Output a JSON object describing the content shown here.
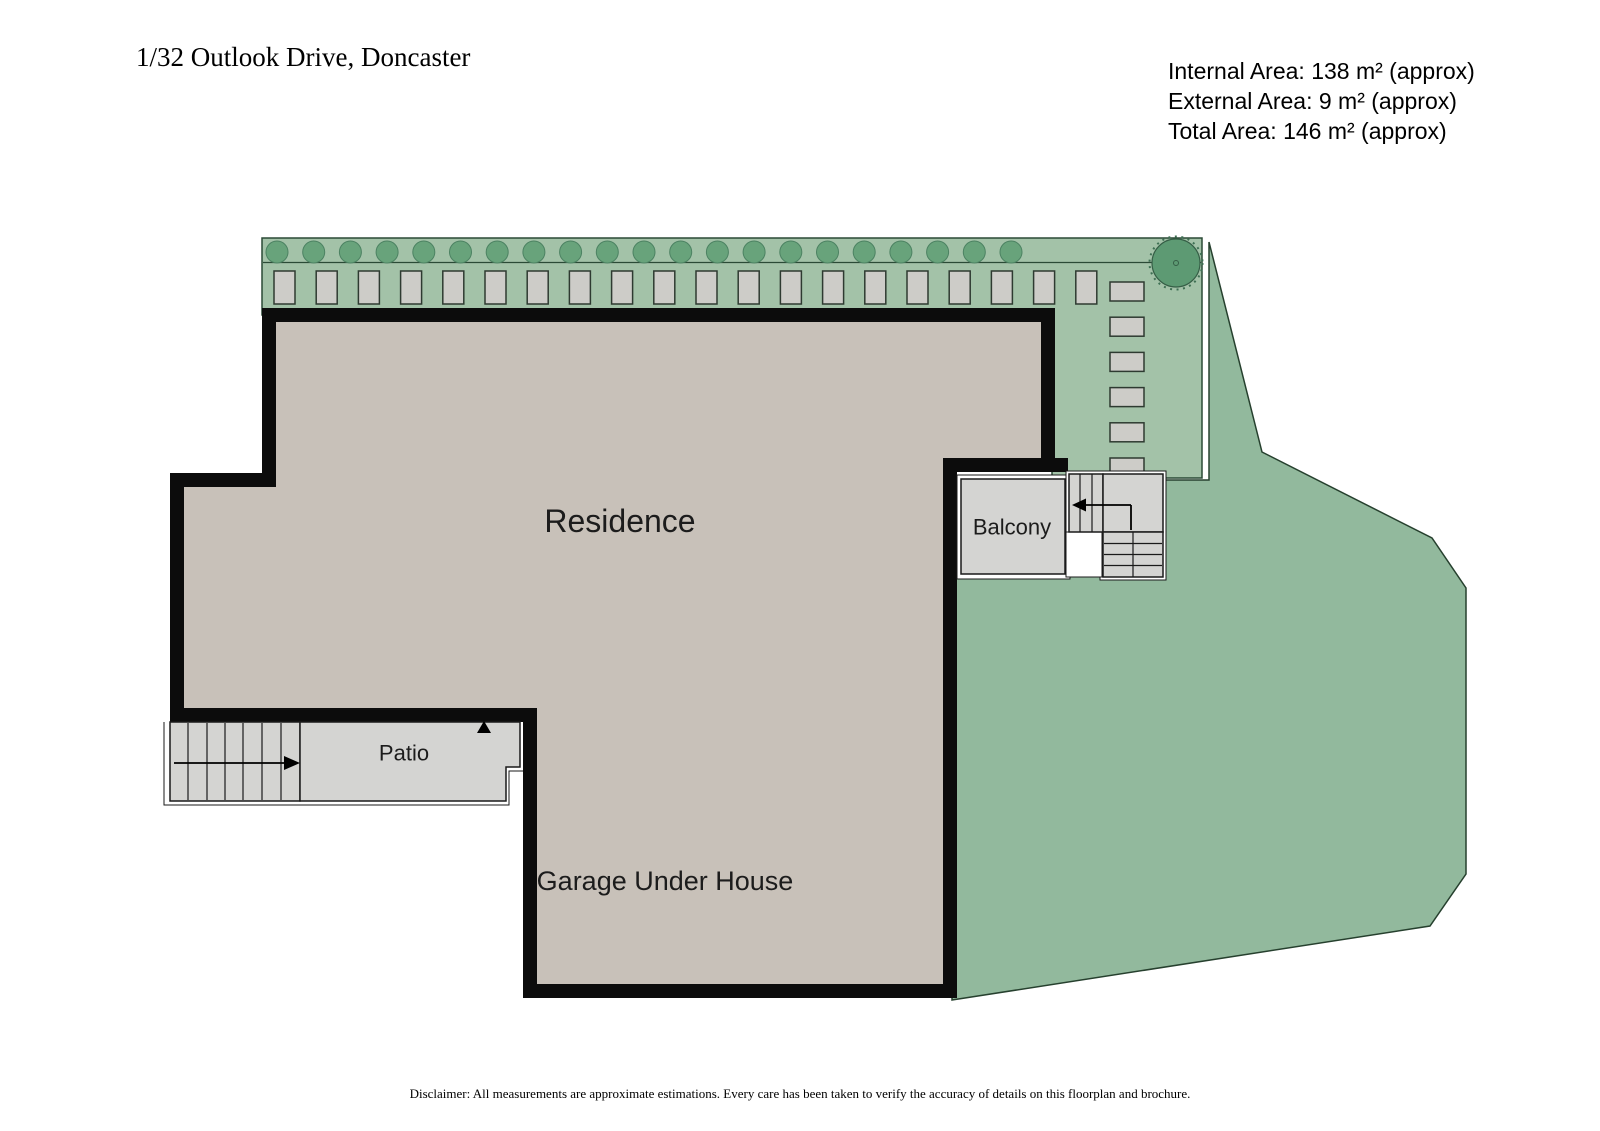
{
  "header": {
    "title": "1/32 Outlook Drive, Doncaster",
    "area_summary": {
      "internal": "Internal Area: 138 m² (approx)",
      "external": "External Area: 9 m² (approx)",
      "total": "Total Area: 146 m² (approx)"
    }
  },
  "floorplan": {
    "labels": {
      "residence": "Residence",
      "garage": "Garage Under House",
      "patio": "Patio",
      "balcony": "Balcony"
    },
    "garden": {
      "shrub_count": 21,
      "hedge_paver_count": 20,
      "side_paver_count": 6,
      "tree_count": 1
    },
    "colors": {
      "wall": "#0c0c0c",
      "floor": "#c8c1b9",
      "paving": "#d4d4d2",
      "paver": "#cdccc8",
      "garden_strip": "#a3c2a8",
      "yard": "#92b99d",
      "shrub": "#68a37b",
      "tree": "#5d9a73",
      "garden_outline": "#2b4a36",
      "line": "#1a1a1a"
    }
  },
  "footer": {
    "disclaimer": "Disclaimer: All measurements are approximate estimations. Every care has been taken to verify the accuracy of details on this floorplan and brochure."
  }
}
